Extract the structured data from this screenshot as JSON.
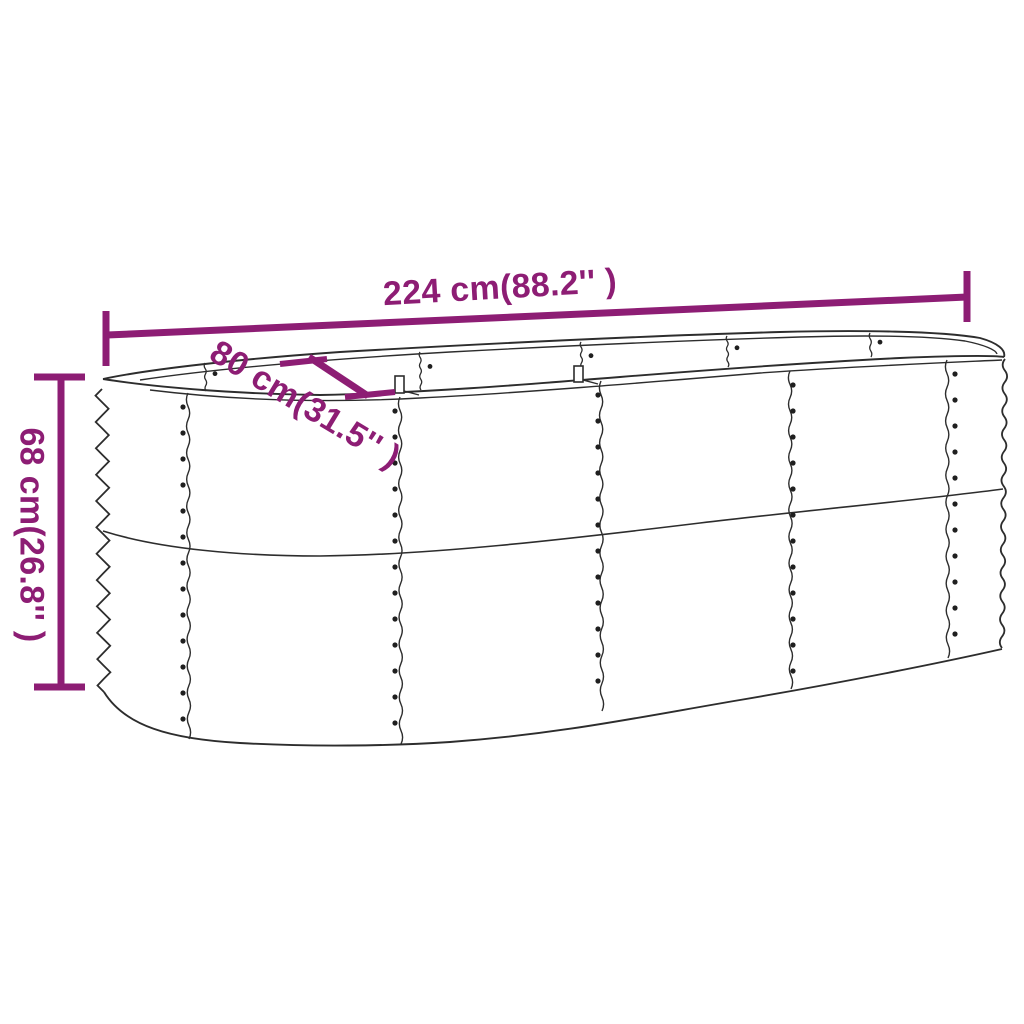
{
  "diagram": {
    "kind": "product-dimension-diagram",
    "subject": "oval corrugated metal raised garden bed",
    "dimensions": {
      "length": {
        "cm": 224,
        "inches": 88.2,
        "label": "224 cm(88.2'' )"
      },
      "width": {
        "cm": 80,
        "inches": 31.5,
        "label": "80 cm(31.5'' )"
      },
      "height": {
        "cm": 68,
        "inches": 26.8,
        "label": "68 cm(26.8'' )"
      }
    },
    "colors": {
      "dimension_accent": "#8d1d74",
      "drawing_outline": "#2d2d2d",
      "background": "#ffffff"
    }
  }
}
